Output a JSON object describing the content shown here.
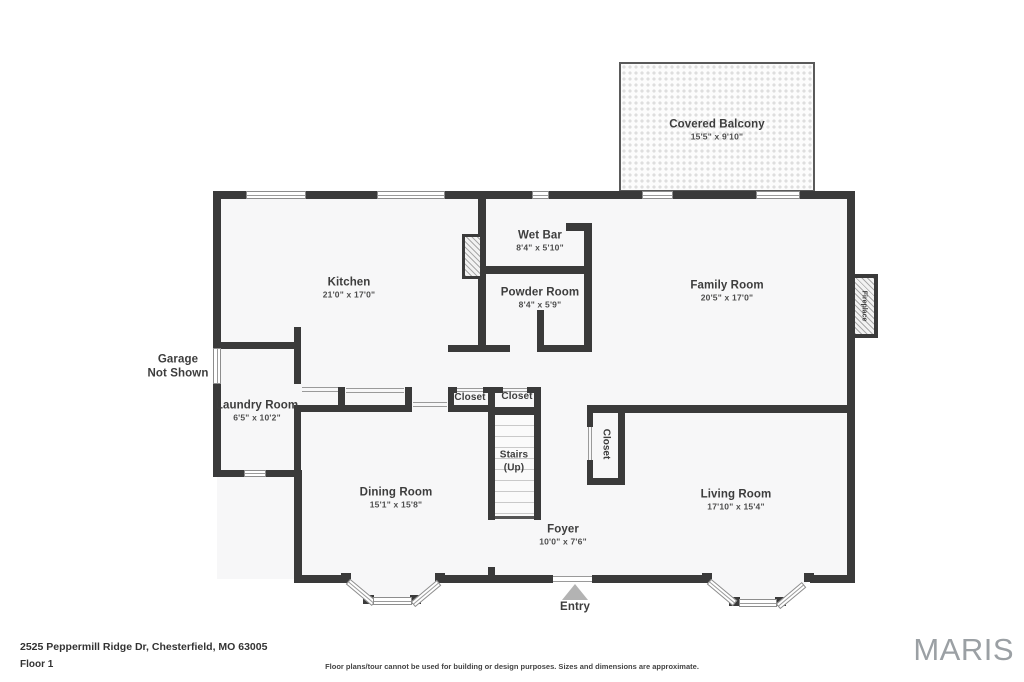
{
  "page": {
    "address": "2525 Peppermill Ridge Dr, Chesterfield, MO 63005",
    "floor_label": "Floor 1",
    "disclaimer": "Floor plans/tour cannot be used for building or design purposes. Sizes and dimensions are approximate.",
    "brand": "MARIS"
  },
  "rooms": {
    "balcony": {
      "name": "Covered Balcony",
      "dims": "15'5\" x 9'10\""
    },
    "kitchen": {
      "name": "Kitchen",
      "dims": "21'0\" x 17'0\""
    },
    "wet_bar": {
      "name": "Wet Bar",
      "dims": "8'4\" x 5'10\""
    },
    "powder_room": {
      "name": "Powder Room",
      "dims": "8'4\" x 5'9\""
    },
    "family_room": {
      "name": "Family Room",
      "dims": "20'5\" x 17'0\""
    },
    "garage_note": {
      "line1": "Garage",
      "line2": "Not Shown"
    },
    "laundry": {
      "name": "Laundry Room",
      "dims": "6'5\" x 10'2\""
    },
    "closet_a": {
      "name": "Closet"
    },
    "closet_b": {
      "name": "Closet"
    },
    "closet_c": {
      "name": "Closet"
    },
    "stairs": {
      "line1": "Stairs",
      "line2": "(Up)"
    },
    "dining": {
      "name": "Dining Room",
      "dims": "15'1\" x 15'8\""
    },
    "living": {
      "name": "Living Room",
      "dims": "17'10\" x 15'4\""
    },
    "foyer": {
      "name": "Foyer",
      "dims": "10'0\" x 7'6\""
    },
    "entry": {
      "name": "Entry"
    },
    "fireplace": {
      "name": "Fireplace"
    }
  },
  "colors": {
    "wall": "#3a3a3a",
    "floor": "#f7f7f8",
    "brand_gray": "#9ba0a4"
  }
}
